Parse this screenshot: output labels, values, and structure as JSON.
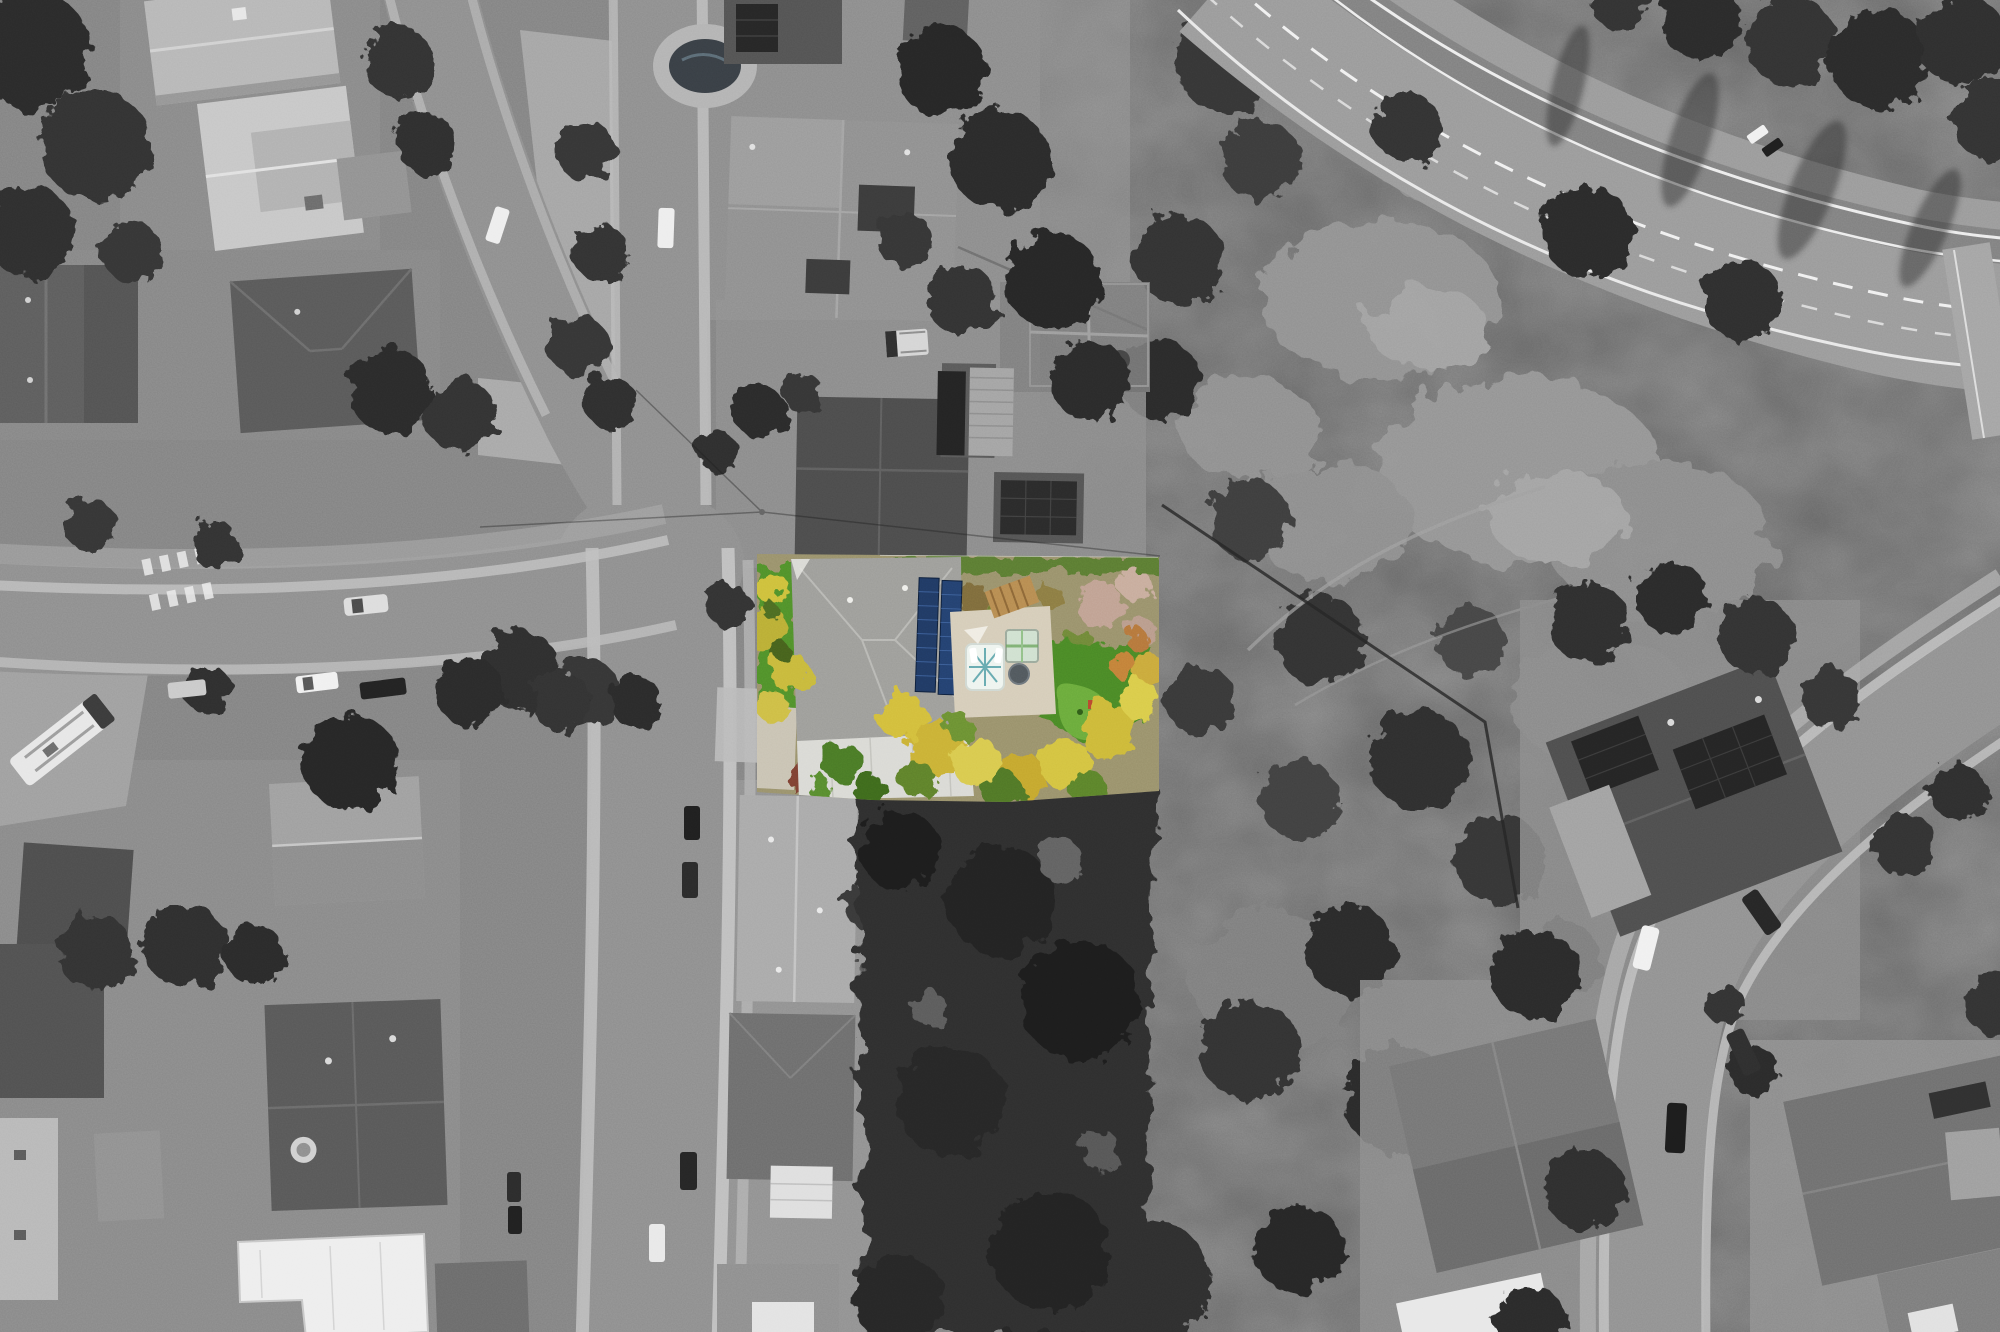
{
  "image": {
    "width": 2000,
    "height": 1332,
    "kind": "aerial-drone-photograph",
    "style": "selective-color: full-color featured lot over grayscale neighborhood",
    "alt_text": "Overhead aerial drone photo of a suburban hillside neighborhood rendered in grayscale, with a single property highlighted in full color: a gray hip-roof house with a dark blue rooftop solar array, bright green front and back lawns, a small pool and round spa on a tan patio, a pergola, a putting green, yellow-green palm trees and yellow flowering shrubs, a concrete driveway and red-brown mulch bed. Curving residential streets with parked cars and an RV lie to the left, dense dark trees and more gray-roofed homes surround the lot, and a brush-covered canyon with a curving multi-lane road crosses the upper right."
  },
  "highlighted_property": {
    "bounds_px": {
      "x": 757,
      "y": 554,
      "width": 402,
      "height": 246
    },
    "features": [
      "main house gray hip roof",
      "rooftop solar panel array (two rows)",
      "white metal garage roof",
      "front lawn",
      "back lawn with putting green",
      "small pool with loungers",
      "round spa",
      "pergola",
      "glass greenhouse",
      "tan concrete patio",
      "yellow flowering shrubs",
      "yellow-green palm trees",
      "concrete driveway",
      "red-brown mulch bed",
      "green hedge along rear fence"
    ],
    "palette": {
      "lawn_green": "#4f8f2a",
      "putting_green": "#69aa3b",
      "shrub_yellow": "#d2bd3a",
      "roof_gray": "#9c9c98",
      "solar_panel_blue": "#203962",
      "patio_tan": "#d5ccb8",
      "white_roof": "#d9d9d4",
      "mulch_brown": "#7c4132",
      "pool_white": "#eef4ef",
      "pool_teal": "#57a0a8",
      "palm_yellow_green": "#cdbf3b"
    }
  },
  "environment": {
    "grayscale": true,
    "features": [
      "S-curving residential street through center-left",
      "side street branching west with crosswalk bars",
      "parked RV at curb on west street",
      "parked cars along curbs",
      "multi-lane highway with white lane markings, top right",
      "curving road with sidewalks, lower right",
      "canyon scrubland with trails and fence lines",
      "gray-roofed houses, several with solar panels",
      "backyard pool on neighboring lot, top center",
      "dense dark tree masses"
    ],
    "palette": {
      "asphalt": "#8d8d8d",
      "highway": "#999999",
      "concrete_curb": "#bdbdbd",
      "roof_dark": "#4c4c4c",
      "roof_light": "#b6b6b6",
      "white_roof": "#ededed",
      "vegetation_dark": "#2e2e2e",
      "canyon_ground": "#6f6f6f",
      "scrub_light": "#919191",
      "car_white": "#ededed",
      "car_dark": "#1f1f1f",
      "lane_marking": "#f0f0f0"
    }
  }
}
